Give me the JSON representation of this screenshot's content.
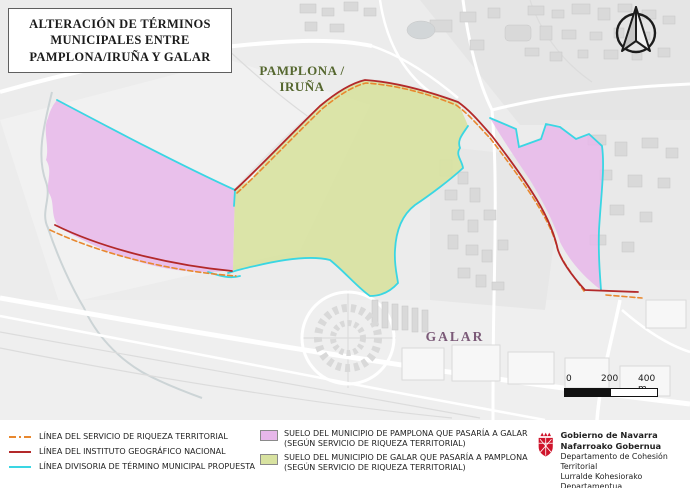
{
  "title": "ALTERACIÓN DE TÉRMINOS MUNICIPALES ENTRE PAMPLONA/IRUÑA Y GALAR",
  "map": {
    "labels": {
      "pamplona": "PAMPLONA / IRUÑA",
      "galar": "GALAR"
    }
  },
  "scale_bar": {
    "tick_0": "0",
    "tick_200": "200",
    "tick_400": "400 m"
  },
  "legend": {
    "lines": [
      {
        "label": "LÍNEA DEL SERVICIO DE RIQUEZA TERRITORIAL",
        "style": "dashed",
        "color": "#e8882f"
      },
      {
        "label": "LÍNEA DEL INSTITUTO GEOGRÁFICO NACIONAL",
        "style": "solid",
        "color": "#b3292a"
      },
      {
        "label": "LÍNEA DIVISORIA DE TÉRMINO MUNICIPAL PROPUESTA",
        "style": "solid",
        "color": "#3ad6e3"
      }
    ],
    "areas": [
      {
        "label": "SUELO DEL MUNICIPIO DE PAMPLONA QUE PASARÍA A GALAR",
        "sublabel": "(SEGÚN SERVICIO DE RIQUEZA TERRITORIAL)",
        "color": "#e7b7ea"
      },
      {
        "label": "SUELO DEL MUNICIPIO DE GALAR QUE PASARÍA A PAMPLONA",
        "sublabel": "(SEGÚN SERVICIO DE RIQUEZA TERRITORIAL)",
        "color": "#d8e2a0"
      }
    ]
  },
  "logo": {
    "org_es": "Gobierno de Navarra",
    "org_eu": "Nafarroako Gobernua",
    "dept_es": "Departamento de Cohesión Territorial",
    "dept_eu": "Lurralde Kohesiorako Departamentua"
  },
  "colors": {
    "pink_fill": "#e7b7ea",
    "green_fill": "#d8e2a0",
    "cyan_line": "#3ad6e3",
    "red_line": "#b3292a",
    "orange_line": "#e8882f",
    "pamplona_label": "#55672f",
    "galar_label": "#7b5a78",
    "navarra_red": "#cf142b"
  }
}
